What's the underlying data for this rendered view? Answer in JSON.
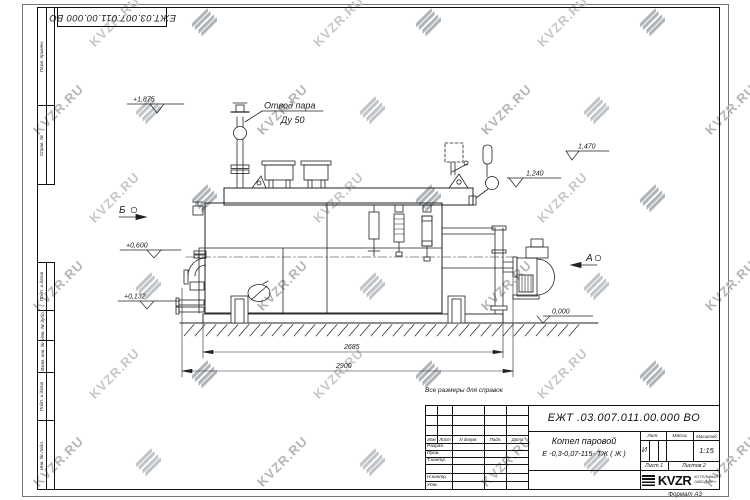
{
  "watermark": {
    "text": "KVZR.RU"
  },
  "frame": {
    "top_stamp_number": "ЕЖТ.03.007.011.00.000  ВО",
    "left_labels_top": [
      "Перв. примен.",
      "Справ. №"
    ],
    "left_labels_bottom": [
      "Подп. и дата",
      "Инв. № дубл.",
      "Взам. инв. №",
      "Подп. и дата",
      "Инв. № подл."
    ],
    "format_label": "Формат А3"
  },
  "note": "Все размеры для справок",
  "title_block": {
    "doc_number": "ЕЖТ .03.007.011.00.000  ВО",
    "name_line1": "Котел паровой",
    "name_line2": "Е -0,3-0,07-115- ТЖ ( Ж )",
    "cols": {
      "izm": "Изм",
      "list": "Лист",
      "ndoc": "N докум.",
      "podp": "Подп.",
      "data": "Дата"
    },
    "rows": {
      "razrab": "Разраб.",
      "prov": "Пров.",
      "tkontr": "Т.контр.",
      "nkontr": "Н.контр.",
      "utv": "Утв."
    },
    "lit_label": "Лит.",
    "mass_label": "Масса",
    "scale_label": "Масштаб",
    "lit_value": "И",
    "scale_value": "1:15",
    "sheet": "Лист 1",
    "sheets": "Листов 2",
    "logo_text": "KVZR",
    "logo_sub_line1": "КОТЕЛЬНЫЙ",
    "logo_sub_line2": "ЗАВОД.РУ"
  },
  "drawing": {
    "callout": {
      "line1": "Отвод пара",
      "line2": "Ду 50"
    },
    "views": {
      "b": "Б",
      "a": "А"
    },
    "elevations": {
      "top": "+1,875",
      "right_upper": "1,470",
      "right_mid": "1,240",
      "left_mid": "+0,600",
      "left_lower": "+0,132",
      "ground": "0,000"
    },
    "dimensions": {
      "inner": "2685",
      "overall": "2900"
    }
  }
}
